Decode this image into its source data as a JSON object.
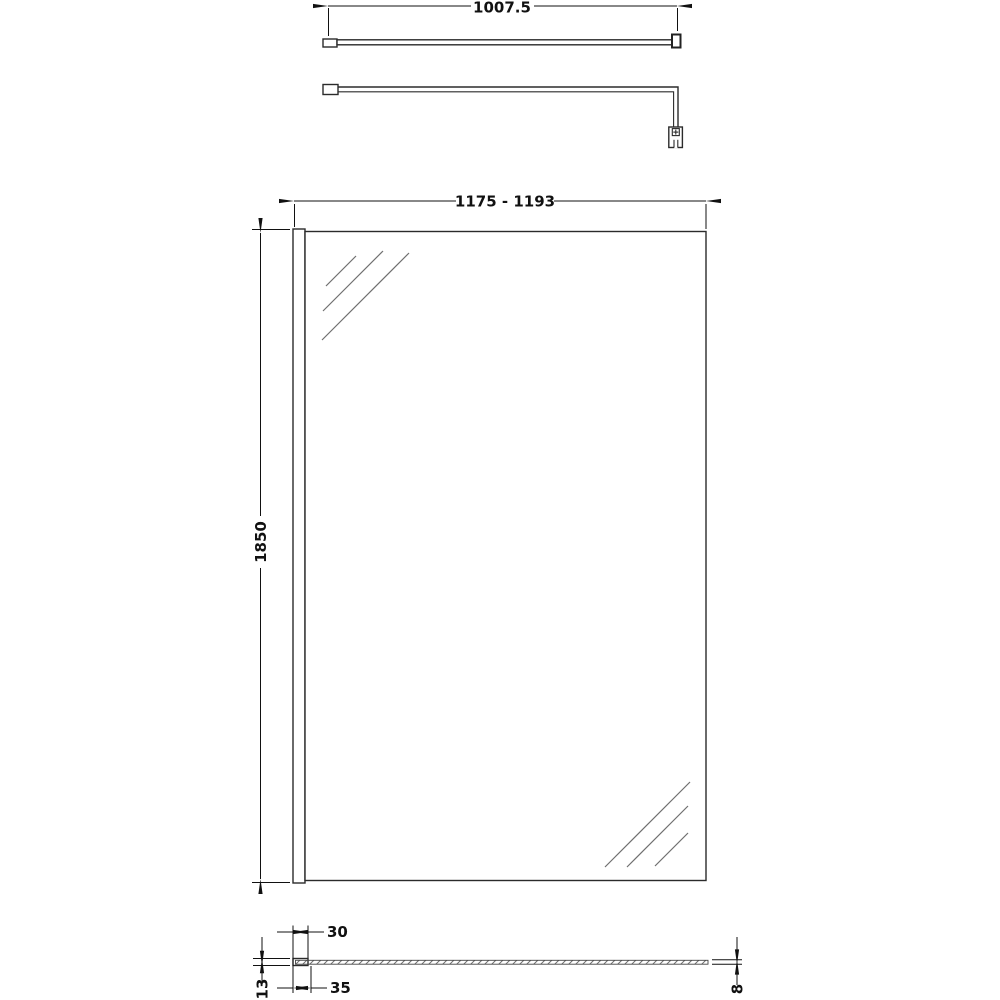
{
  "drawing": {
    "dimensions": {
      "support_bar_length": "1007.5",
      "overall_width": "1175 - 1193",
      "height": "1850",
      "profile_width": "30",
      "profile_depth": "35",
      "profile_thickness": "13",
      "glass_thickness": "8"
    },
    "colors": {
      "line": "#2b2b2b",
      "dimension": "#111111",
      "hatch": "#6f6f6f",
      "background": "#ffffff"
    }
  }
}
